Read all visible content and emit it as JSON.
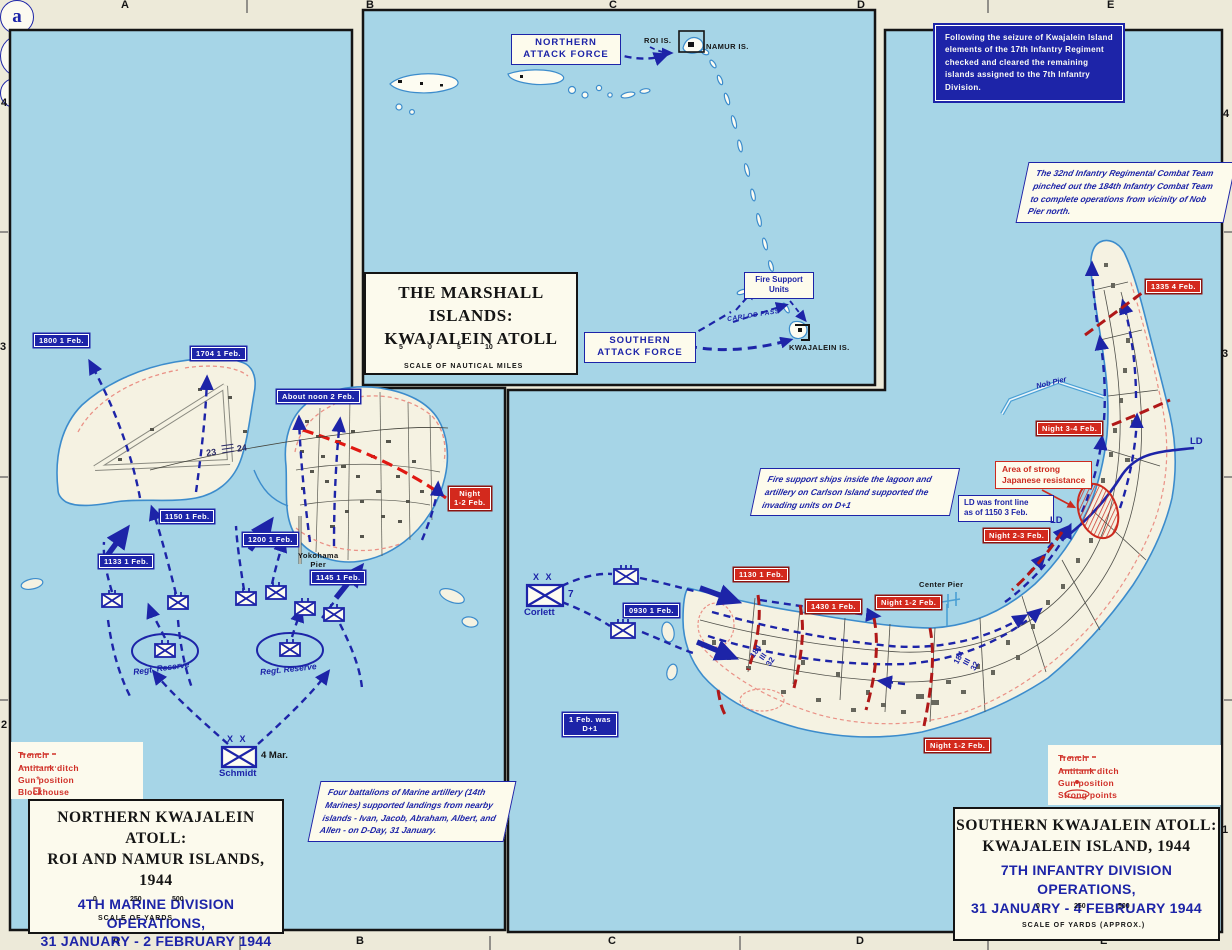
{
  "colors": {
    "water": "#a6d5e7",
    "margin": "#edead9",
    "land": "#f5f2e2",
    "blue": "#1d24a8",
    "red": "#d3291d",
    "dark_red": "#8c1410",
    "legend_red": "#d03028",
    "coast_blue": "#3c8ccc",
    "trench_pink": "#ea9186"
  },
  "badges": {
    "a": "a",
    "b": "b",
    "map_number": "24"
  },
  "grid": {
    "top": [
      "A",
      "B",
      "C",
      "D",
      "E"
    ],
    "bottom": [
      "A",
      "B",
      "C",
      "D",
      "E"
    ],
    "left": [
      "4",
      "3",
      "2"
    ],
    "right": [
      "4",
      "3",
      "1"
    ]
  },
  "inset": {
    "title": "THE MARSHALL ISLANDS:\nKWAJALEIN ATOLL",
    "northern_attack_force": "NORTHERN\nATTACK FORCE",
    "southern_attack_force": "SOUTHERN\nATTACK FORCE",
    "fire_support_units": "Fire Support\nUnits",
    "roi_is": "ROI IS.",
    "namur_is": "NAMUR IS.",
    "kwajalein_is": "KWAJALEIN IS.",
    "carlos_pass": "CARLOS PASS",
    "scale_ticks": [
      "5",
      "0",
      "5",
      "10"
    ],
    "scale_label": "SCALE OF NAUTICAL MILES"
  },
  "notes": {
    "seizure": "Following the seizure of Kwajalein Island elements of the 17th Infantry Regiment checked and cleared the remaining islands assigned to the 7th Infantry Division.",
    "pinched": "The 32nd Infantry Regimental Combat Team pinched out the 184th Infantry Combat Team to complete operations from vicinity of Nob Pier north.",
    "artillery": "Four battalions of Marine artillery (14th Marines) supported landings from nearby islands - Ivan, Jacob, Abraham, Albert, and Allen - on D-Day, 31 January.",
    "fire_support": "Fire support ships inside the lagoon and artillery on Carlson Island supported the invading units on D+1"
  },
  "north_map": {
    "labels": {
      "t1800": "1800 1 Feb.",
      "t1704": "1704 1 Feb.",
      "noon": "About noon 2 Feb.",
      "t1150": "1150 1 Feb.",
      "t1200": "1200 1 Feb.",
      "t1133": "1133 1 Feb.",
      "t1145": "1145 1 Feb.",
      "night12": "Night\n1-2 Feb.",
      "yokohama": "Yokohama\nPier",
      "regt_reserve": "Regt. Reserve",
      "xx": "X X",
      "division": "4 Mar.",
      "commander": "Schmidt",
      "boundary_left": "23",
      "boundary_right": "24"
    },
    "legend": {
      "items": [
        {
          "symbol": "trench-symbol",
          "label": "Trench"
        },
        {
          "symbol": "antitank-ditch-symbol",
          "label": "Antitank ditch"
        },
        {
          "symbol": "gun-position-symbol",
          "label": "Gun position"
        },
        {
          "symbol": "blockhouse-symbol",
          "label": "Blockhouse"
        }
      ]
    },
    "title": {
      "black": "NORTHERN KWAJALEIN ATOLL:\nROI AND NAMUR ISLANDS, 1944",
      "blue": "4TH MARINE DIVISION OPERATIONS,\n31 JANUARY - 2 FEBRUARY 1944",
      "scale_ticks": [
        "0",
        "250",
        "500"
      ],
      "scale_label": "SCALE OF YARDS"
    }
  },
  "south_map": {
    "labels": {
      "t1130": "1130 1 Feb.",
      "t0930": "0930 1 Feb.",
      "t1430": "1430 1 Feb.",
      "night12_mid": "Night 1-2 Feb.",
      "night12_low": "Night 1-2 Feb.",
      "night23": "Night 2-3 Feb.",
      "night34": "Night 3-4 Feb.",
      "t1335": "1335 4 Feb.",
      "dplus": "1 Feb. was\nD+1",
      "ld": "LD",
      "ld_note": "LD was front line\nas of 1150 3 Feb.",
      "resistance": "Area of strong\nJapanese resistance",
      "nob_pier": "Nob Pier",
      "center_pier": "Center Pier",
      "xx": "X X",
      "division": "7",
      "commander": "Corlett",
      "boundary": {
        "a": "184",
        "b": "III",
        "c": "32"
      }
    },
    "legend": {
      "items": [
        {
          "symbol": "trench-symbol",
          "label": "Trench"
        },
        {
          "symbol": "antitank-ditch-symbol",
          "label": "Antitank ditch"
        },
        {
          "symbol": "gun-position-symbol",
          "label": "Gun position"
        },
        {
          "symbol": "strong-points-symbol",
          "label": "Strong points"
        }
      ]
    },
    "title": {
      "black": "SOUTHERN KWAJALEIN ATOLL:\nKWAJALEIN ISLAND, 1944",
      "blue": "7TH INFANTRY DIVISION OPERATIONS,\n31 JANUARY - 4 FEBRUARY 1944",
      "scale_ticks": [
        "0",
        "250",
        "500"
      ],
      "scale_label": "SCALE OF YARDS  (APPROX.)"
    }
  }
}
